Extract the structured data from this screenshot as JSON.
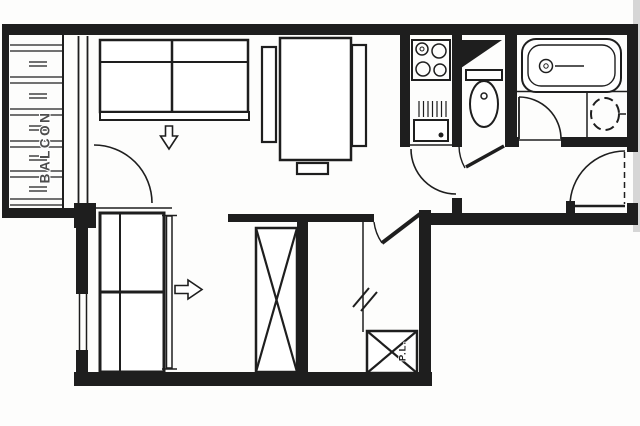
{
  "plan": {
    "labels": {
      "balcony": "BALCON",
      "storage": "P.L."
    },
    "colors": {
      "ink": "#1e1e1e",
      "paper": "#fdfdfc",
      "label": "#4d4d4d",
      "scan_edge": "#cccccc"
    }
  }
}
